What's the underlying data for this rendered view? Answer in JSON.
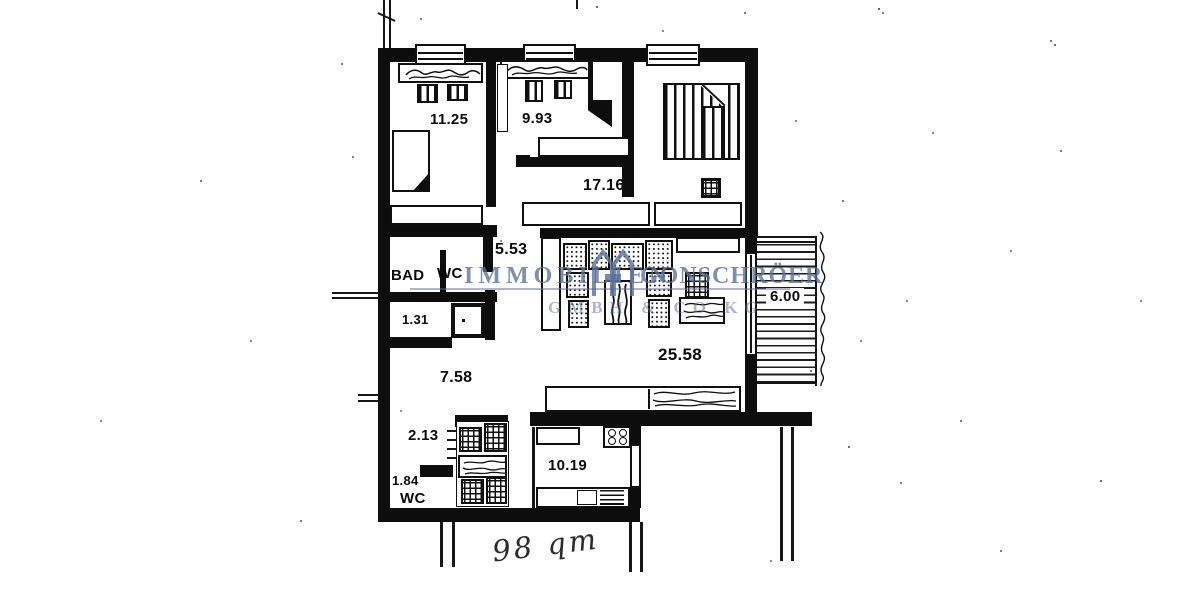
{
  "page": {
    "type": "scanned apartment floor plan",
    "paper_color": "#ffffff",
    "ink_color": "#111111"
  },
  "watermark": {
    "word1": "IMMOBILIEN",
    "word2": "GONSCHRÖER",
    "line2": "GMBH & CO KG",
    "color": "#5a7098",
    "logo": "h-houses-logo"
  },
  "rooms": {
    "bedroom1": {
      "area": "11.25"
    },
    "bedroom2": {
      "area": "9.93"
    },
    "dining_room": {
      "area": "17.16"
    },
    "corridor": {
      "area": "5.53"
    },
    "bath": {
      "name": "BAD"
    },
    "wc_upper": {
      "name": "WC"
    },
    "storage": {
      "area": "1.31"
    },
    "hall": {
      "area": "7.58"
    },
    "vestibule": {
      "area": "2.13"
    },
    "wc_lower": {
      "area": "1.84",
      "name": "WC"
    },
    "kitchen": {
      "area": "10.19"
    },
    "living_room": {
      "area": "25.58"
    },
    "balcony": {
      "length": "6.00"
    }
  },
  "icons": {
    "stove": "stove-burners-icon",
    "logo": "h-houses-logo",
    "beds": "bed-icon",
    "wardrobes": "wardrobe-icon",
    "sink": "sink-icon"
  },
  "annotation": {
    "handwritten_area": "98 qm"
  }
}
